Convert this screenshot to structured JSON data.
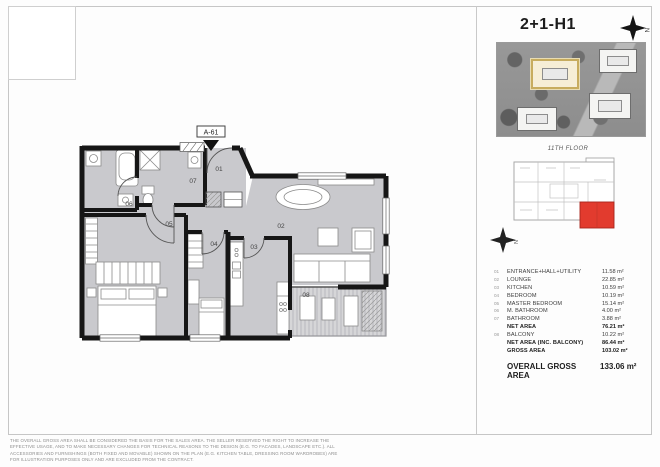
{
  "title": "2+1-H1",
  "compass": {
    "letter": "N"
  },
  "plan": {
    "unit_label": "A-61",
    "room_numbers": [
      "01",
      "02",
      "03",
      "04",
      "05",
      "06",
      "07",
      "08"
    ]
  },
  "key_plan": {
    "floor_label": "11TH FLOOR",
    "highlight_color": "#e23b2e"
  },
  "colors": {
    "plan_floor": "#c9c9cd",
    "wall": "#161616",
    "aerial_highlight": "#c7ac5e"
  },
  "table": {
    "rows": [
      {
        "idx": "01",
        "name": "ENTRANCE+HALL+UTILITY",
        "value": "11.58 m²"
      },
      {
        "idx": "02",
        "name": "LOUNGE",
        "value": "22.85 m²"
      },
      {
        "idx": "03",
        "name": "KITCHEN",
        "value": "10.59 m²"
      },
      {
        "idx": "04",
        "name": "BEDROOM",
        "value": "10.19 m²"
      },
      {
        "idx": "05",
        "name": "MASTER BEDROOM",
        "value": "15.14 m²"
      },
      {
        "idx": "06",
        "name": "M. BATHROOM",
        "value": "4.00 m²"
      },
      {
        "idx": "07",
        "name": "BATHROOM",
        "value": "3.88 m²"
      },
      {
        "idx": "",
        "name": "NET AREA",
        "value": "76.21 m²"
      },
      {
        "idx": "08",
        "name": "BALCONY",
        "value": "10.22 m²"
      },
      {
        "idx": "",
        "name": "NET AREA (INC. BALCONY)",
        "value": "86.44 m²"
      },
      {
        "idx": "",
        "name": "GROSS AREA",
        "value": "103.02 m²"
      }
    ],
    "overall": {
      "name": "OVERALL GROSS AREA",
      "value": "133.06 m²"
    }
  },
  "disclaimer": {
    "line1": "THE OVERALL GROSS AREA SHALL BE CONSIDERED THE BASIS FOR THE SALES AREA. THE SELLER RESERVED THE RIGHT TO INCREASE THE EFFECTIVE USAGE, AND TO MAKE NECESSARY CHANGES FOR TECHNICAL REASONS TO THE DESIGN (E.G. TO FACADES, LANDSCAPE ETC.). ALL",
    "line2": "ACCESSORIES AND FURNISHINGS (BOTH FIXED AND MOVABLE) SHOWN ON THE PLAN (E.G. KITCHEN TABLE, DRESSING ROOM WARDROBES) ARE FOR ILLUSTRATION PURPOSES ONLY AND ARE EXCLUDED FROM THE CONTRACT."
  }
}
